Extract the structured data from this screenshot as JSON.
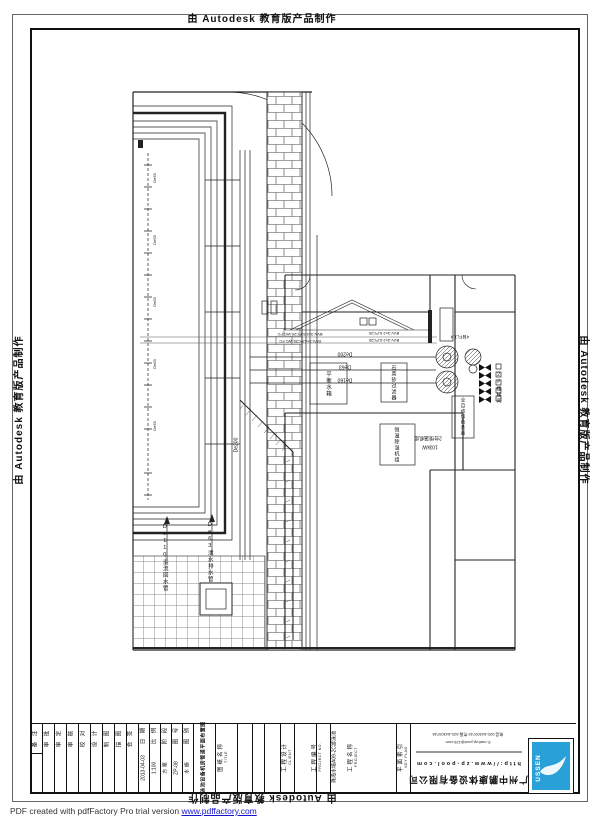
{
  "sheet": {
    "watermark": "由 Autodesk 教育版产品制作"
  },
  "footer": {
    "text": "PDF created with pdfFactory Pro trial version ",
    "link": "www.pdffactory.com"
  },
  "colors": {
    "logo_blue": "#2aa0d8",
    "link_blue": "#1414cc",
    "line_black": "#111111"
  },
  "title_block": {
    "sig_cols": [
      "备 注",
      "审 批",
      "审 定",
      "审 核",
      "校 对",
      "设 计",
      "制 图",
      "描 图",
      "会 签"
    ],
    "fields": [
      {
        "label": "日 期",
        "value": "2013-04-03"
      },
      {
        "label": "比 例",
        "value": "1:100"
      },
      {
        "label": "阶 段",
        "value": "方 案"
      },
      {
        "label": "图 号",
        "value": "ZP-08"
      },
      {
        "label": "图 别",
        "value": "水 施"
      }
    ],
    "drawing_title": "泳池设备机房管道平面布置图",
    "project_name": "珠海水境A09-2C游泳池",
    "label_cols": {
      "title": {
        "zh": "图纸名称",
        "en": "TITLE"
      },
      "client": {
        "zh": "工程设计",
        "en": "CLIENT"
      },
      "project_no": {
        "zh": "工程编号",
        "en": "PROJECT NO."
      },
      "project": {
        "zh": "工程名称",
        "en": "PROJECT"
      },
      "keyplan": {
        "zh": "平面索引",
        "en": "KEY PLAN"
      }
    },
    "company": {
      "name": "广州中鹏康体设备有限公司",
      "contact_line1": "电话:020-84309749 传真:020-84309748",
      "contact_line2": "E-mail:zp-pool@126.com",
      "url": "http://www.zp-pool.com",
      "logo_text": "USSEN"
    }
  },
  "drawing": {
    "labels": {
      "pipe_de200": "De200",
      "pipe_de63": "De63",
      "pipe_de160": "De160",
      "riser_de200": "De200",
      "inlet_de63": "De63",
      "leader_overflow": "De110溢流回水管",
      "leader_drain": "De63泄水排水管",
      "tank_balance": "平衡水箱",
      "filter_sand": "石英砂过滤器",
      "dosing": "全自动加药装置",
      "dehumid": "恒温除湿机组",
      "heatpump_count": "2台恒温机组",
      "heatpump_power": "103kW",
      "cable_a": "BVV-3×2.5-PC20-WC.FC",
      "cable_b": "BVV-3×4-PC25-WC.FC",
      "cable_c": "BVV-3×2.5-PC20",
      "stair": "2#楼梯间",
      "pump_count": "4台FL1.4"
    }
  }
}
